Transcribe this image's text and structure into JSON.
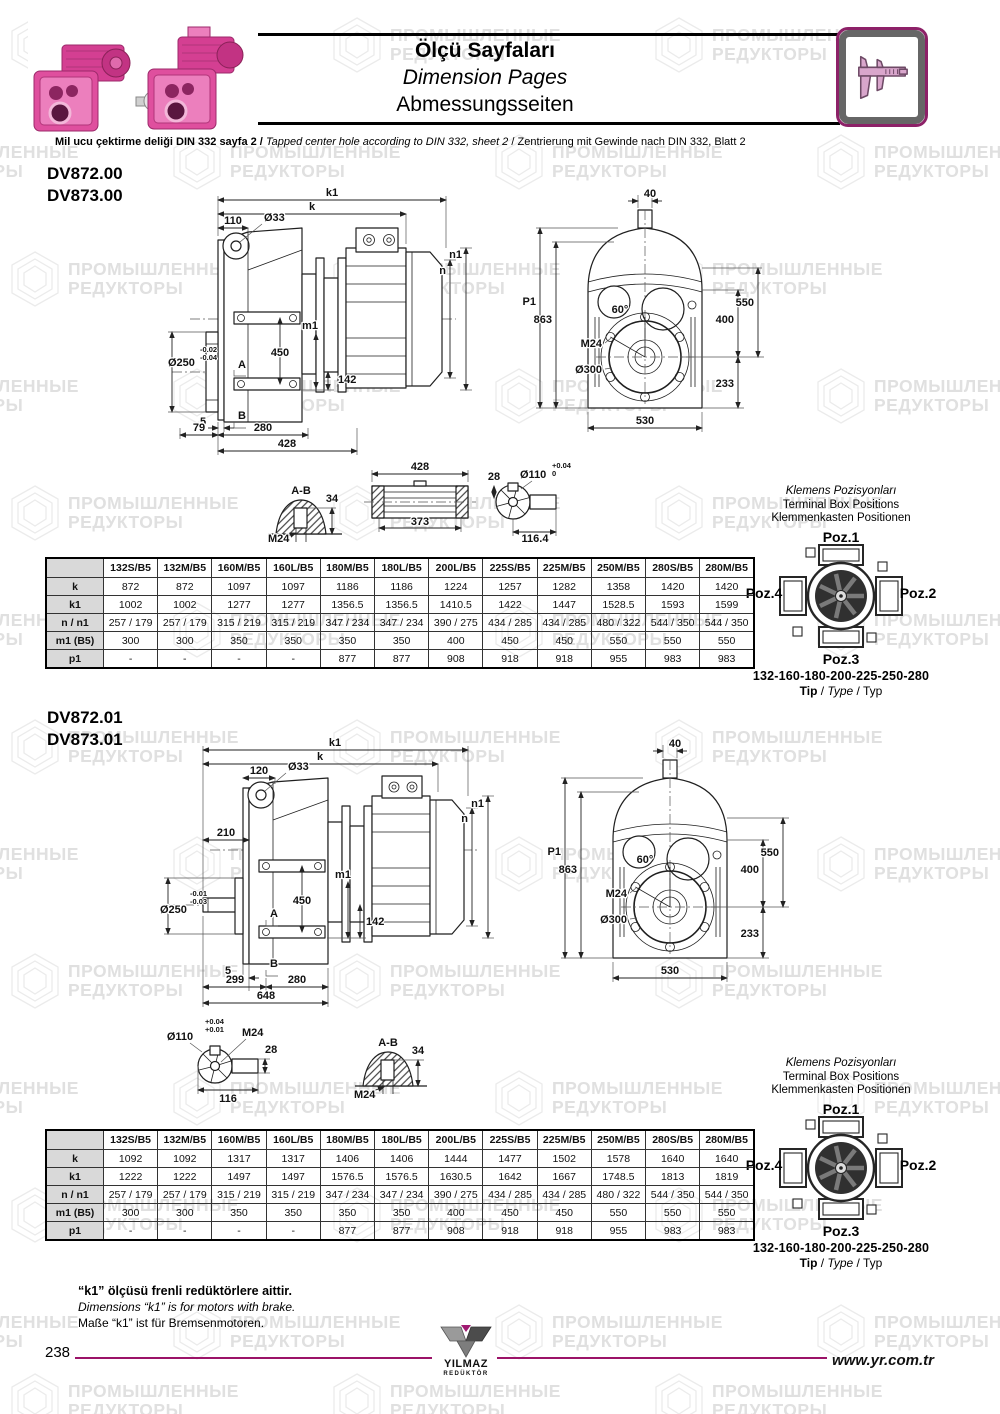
{
  "colors": {
    "accent_magenta": "#9b1368",
    "icon_border_magenta": "#8d2168",
    "motor_pink": "#df4f9e",
    "table_label_bg": "#d9d9d9",
    "watermark_gray": "#e0e0e0"
  },
  "watermark": {
    "line1": "ПРОМЫШЛЕННЫЕ",
    "line2": "РЕДУКТОРЫ"
  },
  "header": {
    "title_tr": "Ölçü Sayfaları",
    "title_en": "Dimension Pages",
    "title_de": "Abmessungsseiten"
  },
  "note": {
    "tr": "Mil ucu çektirme deliği DIN 332 sayfa 2 /",
    "en": "Tapped center hole according to DIN 332, sheet 2",
    "sep": " / ",
    "de": "Zentrierung mit Gewinde nach DIN 332, Blatt 2"
  },
  "terminal": {
    "heading_tr": "Klemens Pozisyonları",
    "heading_en": "Terminal Box Positions",
    "heading_de": "Klemmenkasten Positionen",
    "poz1": "Poz.1",
    "poz2": "Poz.2",
    "poz3": "Poz.3",
    "poz4": "Poz.4",
    "range": "132-160-180-200-225-250-280",
    "tip_tr": "Tip",
    "tip_en": "Type",
    "tip_de": "Typ",
    "tip_sep": " / "
  },
  "sections": [
    {
      "model1": "DV872.00",
      "model2": "DV873.00",
      "side": {
        "k1": "k1",
        "k": "k",
        "w110": "110",
        "d33": "Ø33",
        "n1": "n1",
        "n": "n",
        "m1": "m1",
        "h450": "450",
        "d250": "Ø250",
        "tol_a": "-0.02",
        "tol_b": "-0.04",
        "a": "A",
        "h142": "142",
        "p5": "5",
        "b": "B",
        "w79": "79",
        "w280": "280",
        "w428": "428"
      },
      "front": {
        "w40": "40",
        "p1": "P1",
        "h863": "863",
        "h550": "550",
        "h400": "400",
        "deg": "60°",
        "m24": "M24",
        "d300": "Ø300",
        "h233": "233",
        "w530": "530"
      },
      "detail": {
        "ab": "A-B",
        "k34": "34",
        "m24": "M24",
        "l428": "428",
        "l373": "373",
        "w28": "28",
        "d110": "Ø110",
        "tol_a": "+0.04",
        "tol_b": "0",
        "w116": "116.4"
      },
      "table": {
        "headers": [
          "",
          "132S/B5",
          "132M/B5",
          "160M/B5",
          "160L/B5",
          "180M/B5",
          "180L/B5",
          "200L/B5",
          "225S/B5",
          "225M/B5",
          "250M/B5",
          "280S/B5",
          "280M/B5"
        ],
        "rows": [
          {
            "label": "k",
            "values": [
              "872",
              "872",
              "1097",
              "1097",
              "1186",
              "1186",
              "1224",
              "1257",
              "1282",
              "1358",
              "1420",
              "1420"
            ]
          },
          {
            "label": "k1",
            "values": [
              "1002",
              "1002",
              "1277",
              "1277",
              "1356.5",
              "1356.5",
              "1410.5",
              "1422",
              "1447",
              "1528.5",
              "1593",
              "1599"
            ]
          },
          {
            "label": "n / n1",
            "values": [
              "257 / 179",
              "257 / 179",
              "315 / 219",
              "315 / 219",
              "347 / 234",
              "347 / 234",
              "390 / 275",
              "434 / 285",
              "434 / 285",
              "480 / 322",
              "544 / 350",
              "544 / 350"
            ]
          },
          {
            "label": "m1 (B5)",
            "values": [
              "300",
              "300",
              "350",
              "350",
              "350",
              "350",
              "400",
              "450",
              "450",
              "550",
              "550",
              "550"
            ]
          },
          {
            "label": "p1",
            "values": [
              "-",
              "-",
              "-",
              "-",
              "877",
              "877",
              "908",
              "918",
              "918",
              "955",
              "983",
              "983"
            ]
          }
        ]
      }
    },
    {
      "model1": "DV872.01",
      "model2": "DV873.01",
      "side": {
        "k1": "k1",
        "k": "k",
        "w120": "120",
        "d33": "Ø33",
        "n1": "n1",
        "n": "n",
        "m1": "m1",
        "h450": "450",
        "w210": "210",
        "d250": "Ø250",
        "tol_a": "-0.01",
        "tol_b": "-0.03",
        "a": "A",
        "h142": "142",
        "p5": "5",
        "b": "B",
        "w299": "299",
        "w280": "280",
        "w648": "648"
      },
      "front": {
        "w40": "40",
        "p1": "P1",
        "h863": "863",
        "h550": "550",
        "h400": "400",
        "deg": "60°",
        "m24": "M24",
        "d300": "Ø300",
        "h233": "233",
        "w530": "530"
      },
      "detail": {
        "d110": "Ø110",
        "tol_a": "+0.04",
        "tol_b": "+0.01",
        "m24a": "M24",
        "w28": "28",
        "w116": "116",
        "ab": "A-B",
        "k34": "34",
        "m24b": "M24"
      },
      "table": {
        "headers": [
          "",
          "132S/B5",
          "132M/B5",
          "160M/B5",
          "160L/B5",
          "180M/B5",
          "180L/B5",
          "200L/B5",
          "225S/B5",
          "225M/B5",
          "250M/B5",
          "280S/B5",
          "280M/B5"
        ],
        "rows": [
          {
            "label": "k",
            "values": [
              "1092",
              "1092",
              "1317",
              "1317",
              "1406",
              "1406",
              "1444",
              "1477",
              "1502",
              "1578",
              "1640",
              "1640"
            ]
          },
          {
            "label": "k1",
            "values": [
              "1222",
              "1222",
              "1497",
              "1497",
              "1576.5",
              "1576.5",
              "1630.5",
              "1642",
              "1667",
              "1748.5",
              "1813",
              "1819"
            ]
          },
          {
            "label": "n / n1",
            "values": [
              "257 / 179",
              "257 / 179",
              "315 / 219",
              "315 / 219",
              "347 / 234",
              "347 / 234",
              "390 / 275",
              "434 / 285",
              "434 / 285",
              "480 / 322",
              "544 / 350",
              "544 / 350"
            ]
          },
          {
            "label": "m1 (B5)",
            "values": [
              "300",
              "300",
              "350",
              "350",
              "350",
              "350",
              "400",
              "450",
              "450",
              "550",
              "550",
              "550"
            ]
          },
          {
            "label": "p1",
            "values": [
              "-",
              "-",
              "-",
              "-",
              "877",
              "877",
              "908",
              "918",
              "918",
              "955",
              "983",
              "983"
            ]
          }
        ]
      }
    }
  ],
  "footnote": {
    "tr": "“k1” ölçüsü frenli redüktörlere aittir.",
    "en": "Dimensions “k1” is for motors with brake.",
    "de": "Maße “k1” ist für Bremsenmotoren."
  },
  "footer": {
    "page": "238",
    "brand1": "YILMAZ",
    "brand2": "REDÜKTÖR",
    "site": "www.yr.com.tr"
  }
}
